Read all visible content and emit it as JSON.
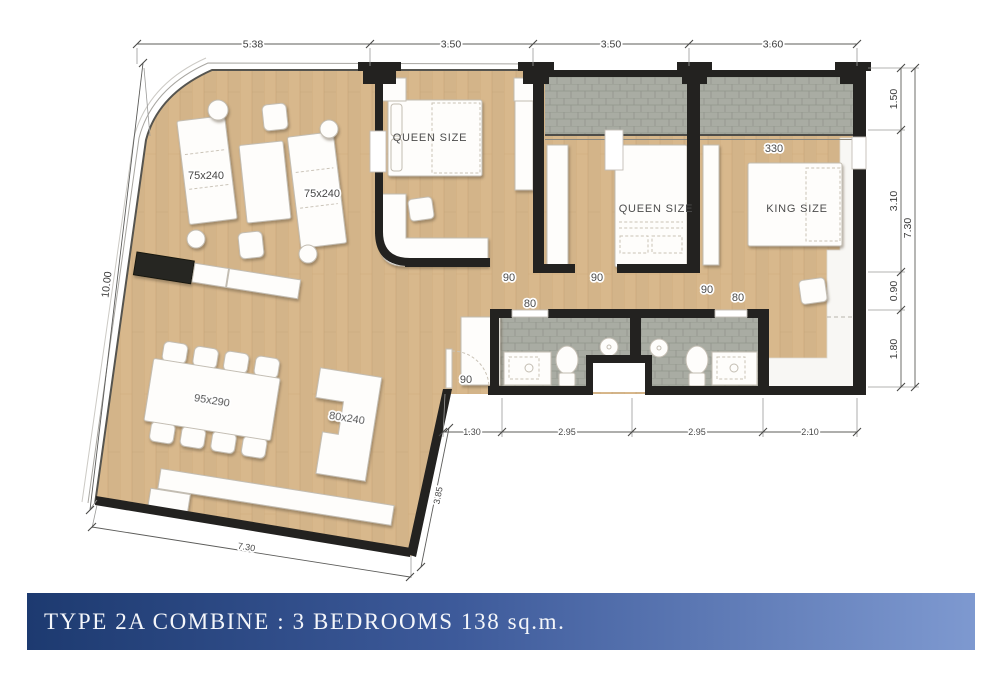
{
  "banner": {
    "text": "TYPE 2A COMBINE : 3 BEDROOMS 138 sq.m."
  },
  "dimensions": {
    "top": [
      "5.38",
      "3.50",
      "3.50",
      "3.60"
    ],
    "right": [
      "1.50",
      "3.10",
      "0.90",
      "1.80"
    ],
    "right_total": "7.30",
    "left": "10.00",
    "bottom": [
      "1.30",
      "2.95",
      "2.95",
      "2.10"
    ],
    "bottom_edge": "7.30",
    "diagonal": "3.85"
  },
  "rooms": {
    "bedroom1": {
      "bed": "QUEEN SIZE",
      "door": "90"
    },
    "bedroom2": {
      "bed": "QUEEN SIZE",
      "door": "90"
    },
    "bedroom3": {
      "bed": "KING SIZE",
      "door": "90",
      "width": "330"
    },
    "bathroom1": {
      "door": "80"
    },
    "bathroom2": {
      "door": "80"
    },
    "hall": {
      "door": "90"
    }
  },
  "furniture": {
    "lounger1": "75x240",
    "lounger2": "75x240",
    "dining_table": "95x290",
    "kitchen_counter": "80x240"
  },
  "colors": {
    "wood": "#d8b88c",
    "wood_line": "#c7a374",
    "tile": "#a9aca3",
    "tile_line": "#91958c",
    "wall": "#232220",
    "banner_from": "#1d3a70",
    "banner_to": "#7e99d0",
    "label_text": "#3b3b3b"
  }
}
